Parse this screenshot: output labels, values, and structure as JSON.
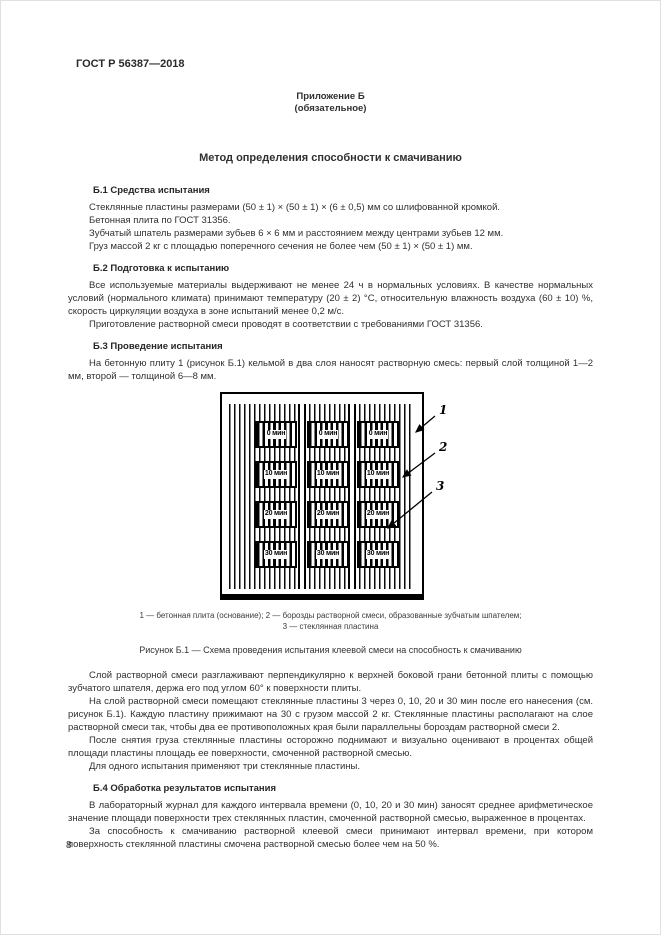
{
  "doc": {
    "code": "ГОСТ Р 56387—2018",
    "page_number": "8"
  },
  "appendix": {
    "label": "Приложение Б",
    "type": "(обязательное)",
    "title": "Метод определения способности к смачиванию"
  },
  "sections": [
    {
      "heading": "Б.1 Средства испытания",
      "paras": [
        "Стеклянные пластины размерами (50 ± 1) × (50 ± 1) × (6 ± 0,5) мм со шлифованной кромкой.",
        "Бетонная плита по ГОСТ 31356.",
        "Зубчатый шпатель размерами зубьев 6 × 6 мм и расстоянием между центрами зубьев 12 мм.",
        "Груз массой 2 кг с площадью поперечного сечения не более чем (50 ± 1) × (50 ± 1) мм."
      ]
    },
    {
      "heading": "Б.2 Подготовка к испытанию",
      "paras": [
        "Все используемые материалы выдерживают не менее 24 ч в нормальных условиях. В качестве нормальных условий (нормального климата) принимают температуру (20 ± 2) °С, относительную влажность воздуха (60 ± 10) %, скорость циркуляции воздуха в зоне испытаний менее 0,2 м/с.",
        "Приготовление растворной смеси проводят в соответствии с требованиями ГОСТ 31356."
      ]
    },
    {
      "heading": "Б.3 Проведение испытания",
      "paras": [
        "На бетонную плиту 1 (рисунок Б.1) кельмой в два слоя наносят растворную смесь: первый слой толщиной 1—2 мм, второй — толщиной 6—8 мм."
      ]
    }
  ],
  "figure": {
    "callouts": [
      "1",
      "2",
      "3"
    ],
    "time_labels": [
      "0 мин",
      "10 мин",
      "20 мин",
      "30 мин"
    ],
    "legend_line1": "1 — бетонная плита (основание); 2 — борозды растворной смеси, образованные зубчатым шпателем;",
    "legend_line2": "3 — стеклянная пластина",
    "caption": "Рисунок Б.1 — Схема проведения испытания клеевой смеси на способность к смачиванию"
  },
  "post_figure_paras": [
    "Слой растворной смеси разглаживают перпендикулярно к верхней боковой грани бетонной плиты с помощью зубчатого шпателя, держа его под углом 60° к поверхности плиты.",
    "На слой растворной смеси помещают стеклянные пластины 3 через 0, 10, 20 и 30 мин после его нанесения (см. рисунок Б.1). Каждую пластину прижимают на 30 с грузом массой 2 кг. Стеклянные пластины располагают на слое растворной смеси так, чтобы два ее противоположных края были параллельны бороздам растворной смеси 2.",
    "После снятия груза стеклянные пластины осторожно поднимают и визуально оценивают в процентах общей площади пластины площадь ее поверхности, смоченной растворной смесью.",
    "Для одного испытания применяют три стеклянные пластины."
  ],
  "section_b4": {
    "heading": "Б.4 Обработка результатов испытания",
    "paras": [
      "В лабораторный журнал для каждого интервала времени (0, 10, 20 и 30 мин) заносят среднее арифметическое значение площади поверхности трех стеклянных пластин, смоченной растворной смесью, выраженное в процентах.",
      "За способность к смачиванию растворной клеевой смеси принимают интервал времени, при котором поверхность стеклянной пластины смочена растворной смесью более чем на 50 %."
    ]
  }
}
